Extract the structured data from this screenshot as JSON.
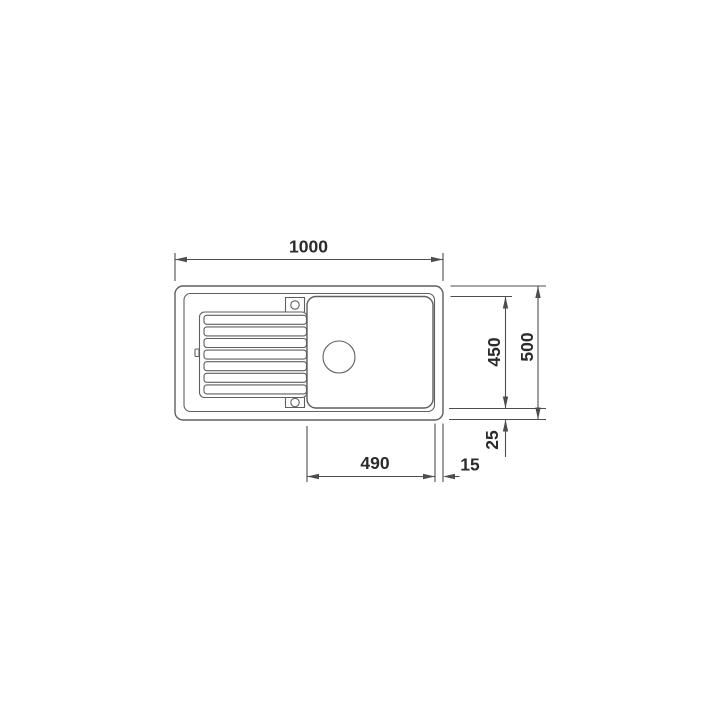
{
  "drawing": {
    "title": "kitchen-sink-top-view-dimension-drawing",
    "dimension_labels": {
      "overall_width": "1000",
      "overall_depth": "500",
      "inner_depth": "450",
      "bowl_width": "490",
      "rim_offset_bottom": "25",
      "rim_offset_right": "15"
    },
    "colors": {
      "outline": "#5f5f5f",
      "dimension": "#4d4d4d",
      "label_text": "#2b2b2b",
      "background": "#ffffff"
    }
  }
}
